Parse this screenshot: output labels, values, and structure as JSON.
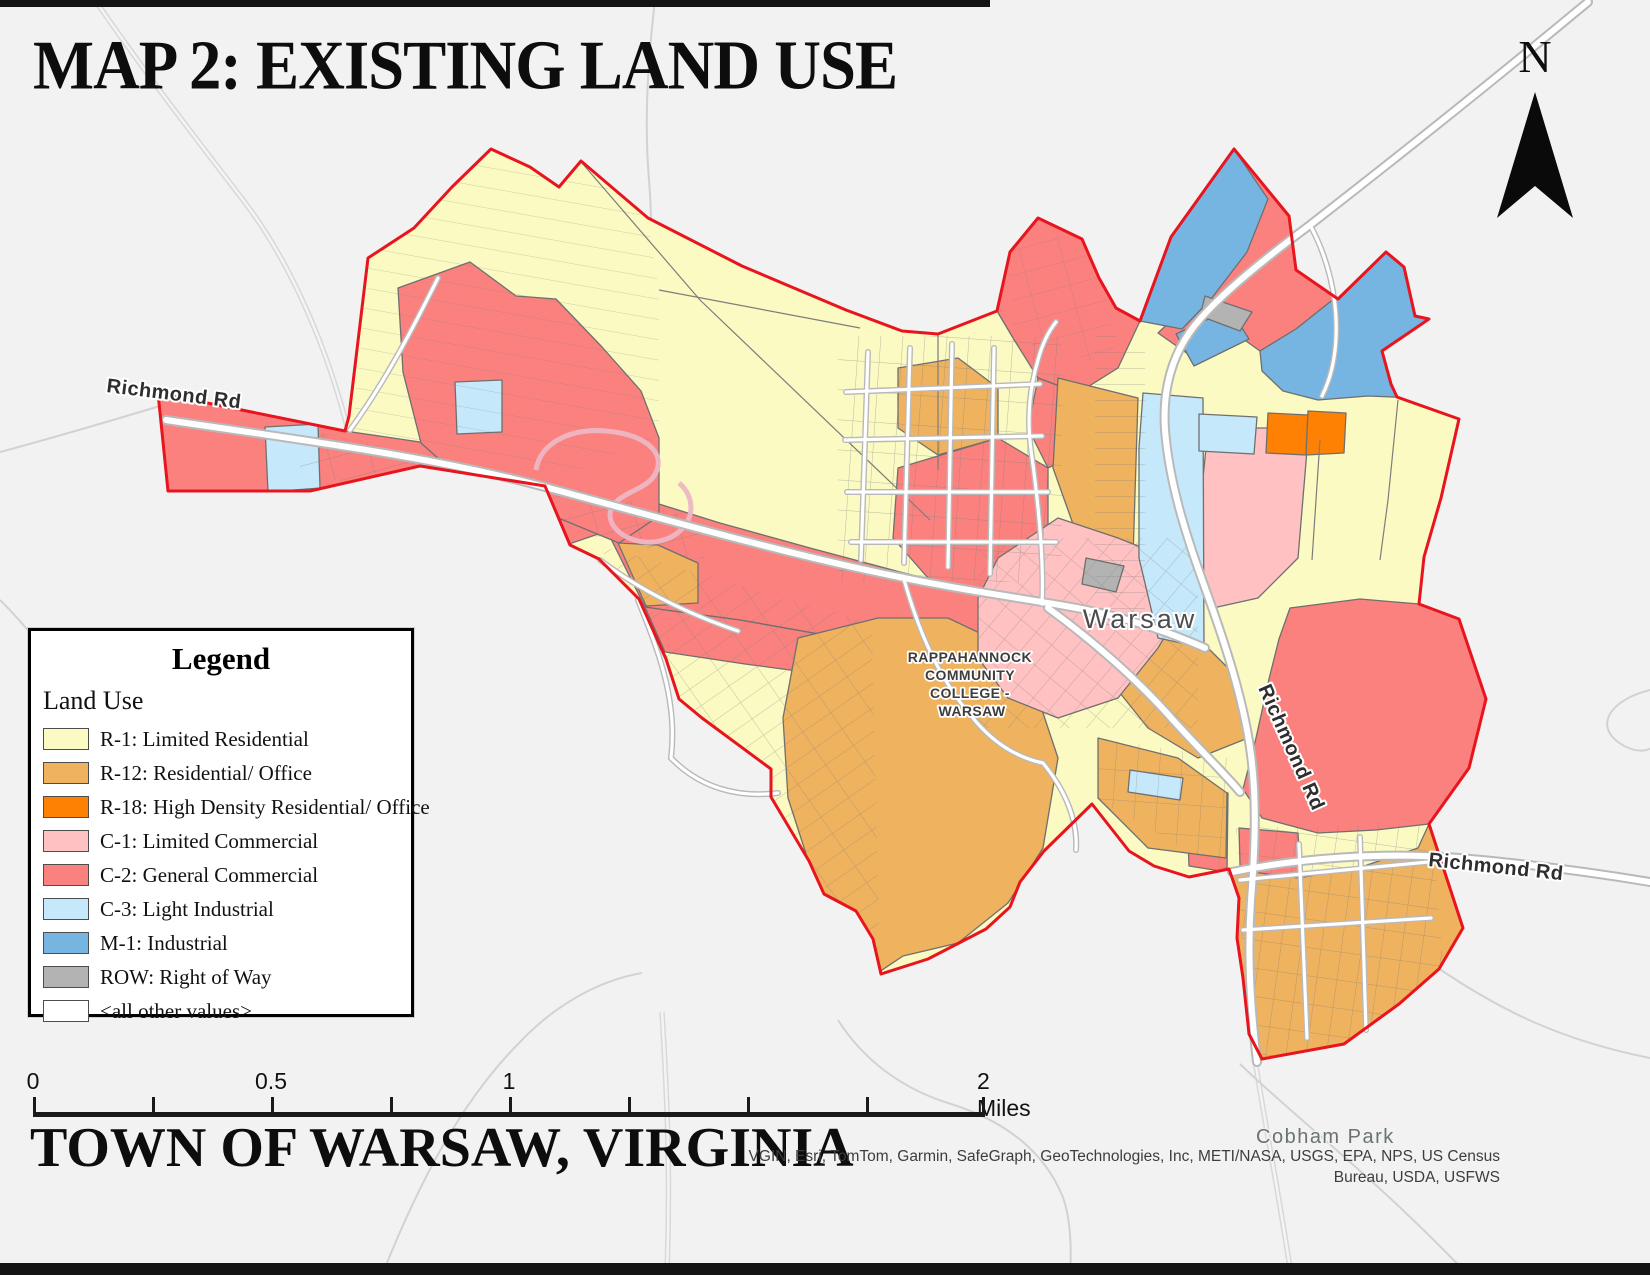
{
  "title": "MAP 2: EXISTING LAND USE",
  "subtitle": "TOWN OF WARSAW, VIRGINIA",
  "north_label": "N",
  "legend": {
    "title": "Legend",
    "section": "Land Use",
    "items": [
      {
        "code": "R-1",
        "label": "R-1: Limited Residential",
        "color": "#FAFAC2"
      },
      {
        "code": "R-12",
        "label": "R-12: Residential/ Office",
        "color": "#EFB25E"
      },
      {
        "code": "R-18",
        "label": "R-18: High Density Residential/ Office",
        "color": "#FF8104"
      },
      {
        "code": "C-1",
        "label": "C-1: Limited Commercial",
        "color": "#FFC1C1"
      },
      {
        "code": "C-2",
        "label": "C-2: General Commercial",
        "color": "#FB817F"
      },
      {
        "code": "C-3",
        "label": "C-3: Light Industrial",
        "color": "#C6E8FB"
      },
      {
        "code": "M-1",
        "label": "M-1: Industrial",
        "color": "#76B4E2"
      },
      {
        "code": "ROW",
        "label": "ROW: Right of Way",
        "color": "#B3B3B3"
      },
      {
        "code": "OTHER",
        "label": "<all other values>",
        "color": "#FFFFFF"
      }
    ]
  },
  "scale_bar": {
    "labels": [
      "0",
      "0.5",
      "1",
      "2 Miles"
    ]
  },
  "map_labels": {
    "road_west": "Richmond Rd",
    "road_east_vertical": "Richmond Rd",
    "road_southeast": "Richmond Rd",
    "town": "Warsaw",
    "college": [
      "RAPPAHANNOCK",
      "COMMUNITY",
      "COLLEGE -",
      "WARSAW"
    ],
    "park": "Cobham Park"
  },
  "credits": {
    "line1": "VGIN, Esri, TomTom, Garmin, SafeGraph, GeoTechnologies, Inc, METI/NASA, USGS, EPA, NPS, US Census",
    "line2": "Bureau, USDA, USFWS"
  },
  "boundary_color": "#E8141E"
}
